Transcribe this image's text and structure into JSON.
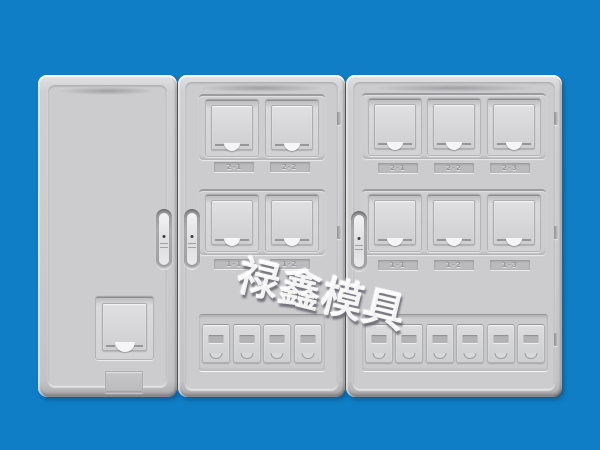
{
  "scene": {
    "description": "Three-door electric energy meter box enclosure product render",
    "background_color": "#0f7ec6",
    "panel_color": "#cbcbcd",
    "watermark_color": "#ffffff"
  },
  "watermark": {
    "text": "禄鑫模具"
  },
  "left_panel": {
    "type": "blank service door",
    "features": [
      "door-handle",
      "card-reader-window",
      "nameplate"
    ]
  },
  "middle_panel": {
    "type": "2x2 meter door",
    "meter_rows": [
      {
        "labels": [
          "2-1",
          "2-2"
        ]
      },
      {
        "labels": [
          "1-1",
          "1-2"
        ]
      }
    ],
    "breaker_windows": 4
  },
  "right_panel": {
    "type": "2x3 meter door",
    "meter_rows": [
      {
        "labels": [
          "2-1",
          "2-2",
          "2-3"
        ]
      },
      {
        "labels": [
          "1-1",
          "1-2",
          "1-3"
        ]
      }
    ],
    "breaker_windows": 6
  }
}
